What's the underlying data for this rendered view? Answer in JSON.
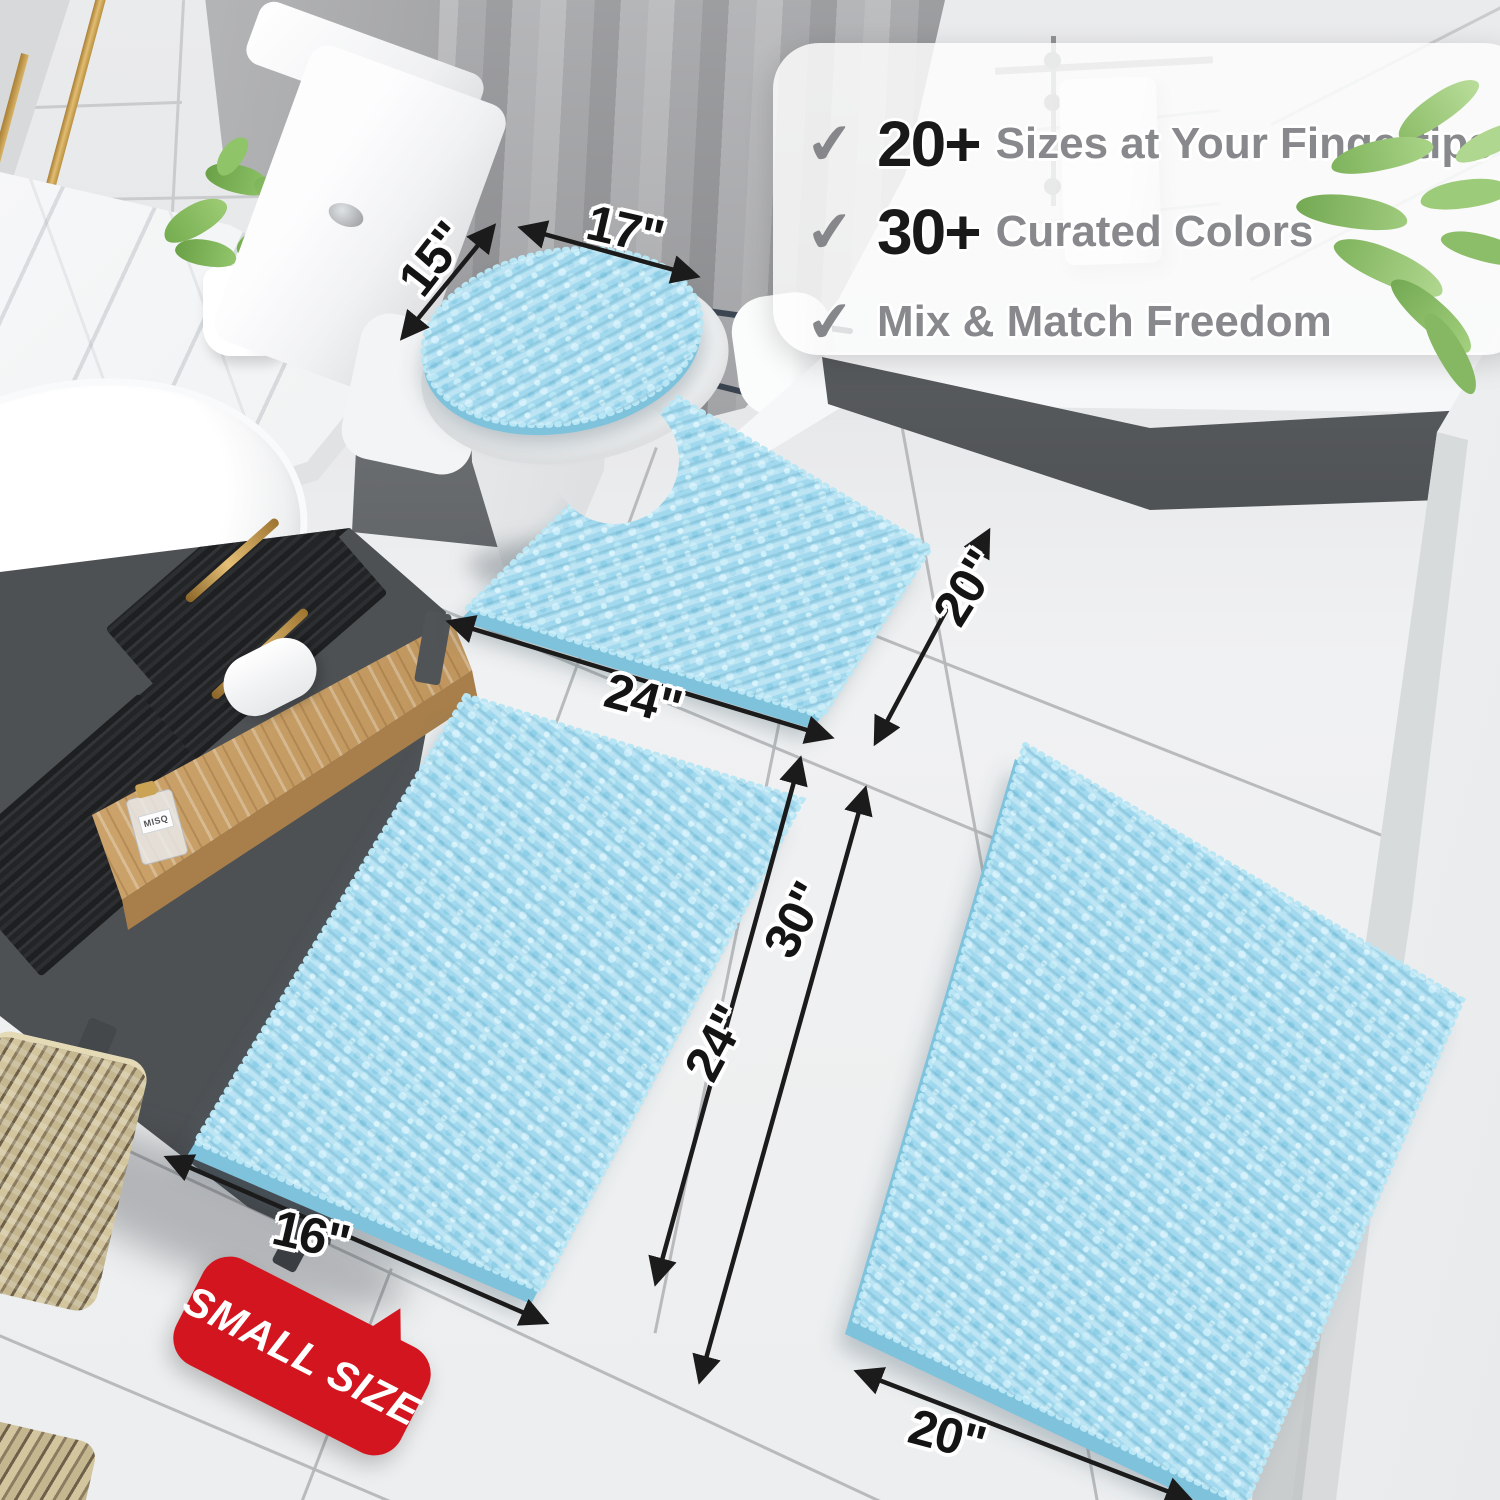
{
  "icons": {
    "check": "✔"
  },
  "callout": {
    "items": [
      {
        "number": "20+",
        "label": "Sizes at Your Fingertips"
      },
      {
        "number": "30+",
        "label": "Curated Colors"
      },
      {
        "number": "",
        "label": "Mix & Match Freedom"
      }
    ]
  },
  "dimensions": {
    "lid_cover": {
      "width": "15\"",
      "length": "17\""
    },
    "contour_mat": {
      "width": "24\"",
      "depth": "20\""
    },
    "small_rug": {
      "length": "24\"",
      "width": "16\""
    },
    "large_rug": {
      "length": "30\"",
      "width": "20\""
    }
  },
  "badge": {
    "label": "SMALL SIZE"
  },
  "vanity": {
    "bottle_label": "MISQ"
  },
  "colors": {
    "rug_blue": "#a3d9ee",
    "rug_edge_blue": "#7fc2dc",
    "badge_red": "#d2151e",
    "arrow_black": "#1b1b1b",
    "callout_number": "#19191a",
    "callout_text_gray": "#87898c"
  }
}
